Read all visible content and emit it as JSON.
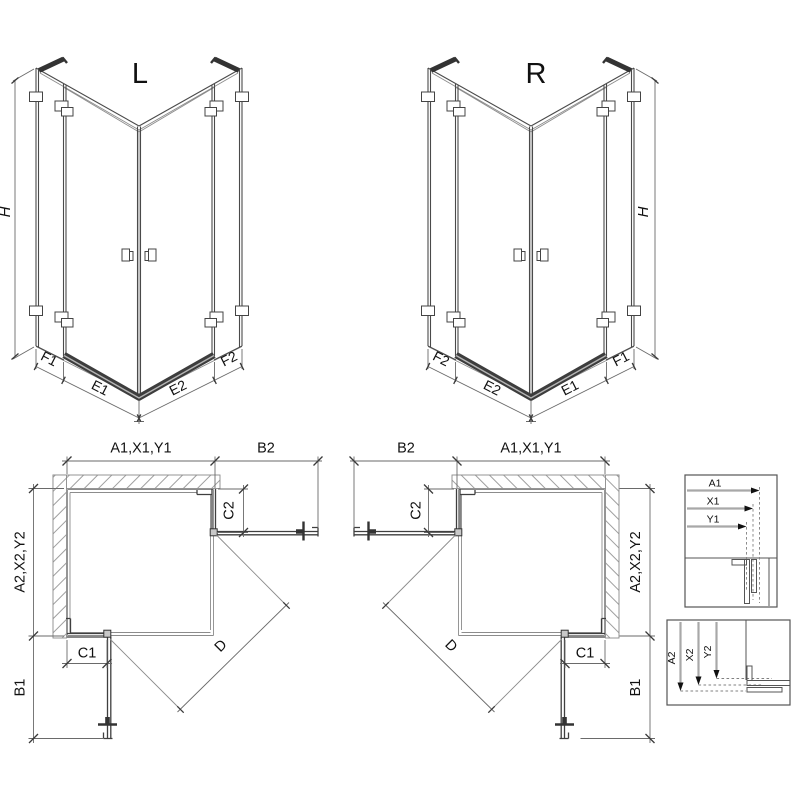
{
  "diagram": {
    "iso_left": {
      "label": "L",
      "height": "H",
      "widths": [
        "F1",
        "E1",
        "E2",
        "F2"
      ]
    },
    "iso_right": {
      "label": "R",
      "height": "H",
      "widths": [
        "F2",
        "E2",
        "E1",
        "F1"
      ]
    },
    "plan_left": {
      "top_width": "A1,X1,Y1",
      "door_open_side": "B2",
      "fixed_side": "C2",
      "depth": "A2,X2,Y2",
      "fixed_front": "C1",
      "door_open_front": "B1",
      "diagonal": "D"
    },
    "plan_right": {
      "top_width": "A1,X1,Y1",
      "door_open_side": "B2",
      "fixed_side": "C2",
      "depth": "A2,X2,Y2",
      "fixed_front": "C1",
      "door_open_front": "B1",
      "diagonal": "D"
    },
    "detail_width": {
      "labels": [
        "A1",
        "X1",
        "Y1"
      ]
    },
    "detail_depth": {
      "labels": [
        "A2",
        "X2",
        "Y2"
      ]
    },
    "colors": {
      "line": "#4a4a4a",
      "dim": "#6a6a6a",
      "hatch": "#9f9f9f",
      "sill": "#3d3d3d",
      "text": "#111111",
      "glass": "#8c8c8c"
    }
  }
}
